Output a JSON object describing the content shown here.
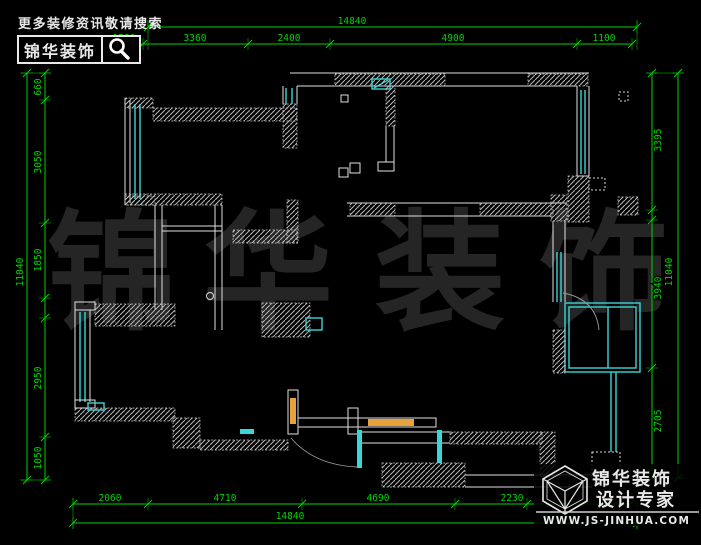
{
  "header": {
    "tagline": "更多装修资讯敬请搜索",
    "brand": "锦华装饰"
  },
  "watermark": [
    "锦",
    "华",
    "装",
    "饰"
  ],
  "footer": {
    "brand_line1": "锦华装饰",
    "brand_line2": "设计专家",
    "website": "WWW.JS-JINHUA.COM"
  },
  "dimensions": {
    "top": {
      "total": "14840",
      "chain": [
        "1580",
        "3360",
        "2400",
        "4900",
        "1100"
      ]
    },
    "bottom": {
      "total": "14840",
      "chain": [
        "2060",
        "4710",
        "4690",
        "2230"
      ]
    },
    "left": {
      "total": "11040",
      "chain": [
        "660",
        "3050",
        "1850",
        "2950",
        "1050"
      ]
    },
    "right": {
      "total": "11040",
      "chain": [
        "3395",
        "3940",
        "2705"
      ]
    }
  },
  "colors": {
    "dimension_green": "#00d400",
    "window_cyan": "#3ad6d6",
    "cabinet_orange": "#e8a23c",
    "wall_white": "#e0e0e0",
    "background": "#000000"
  }
}
